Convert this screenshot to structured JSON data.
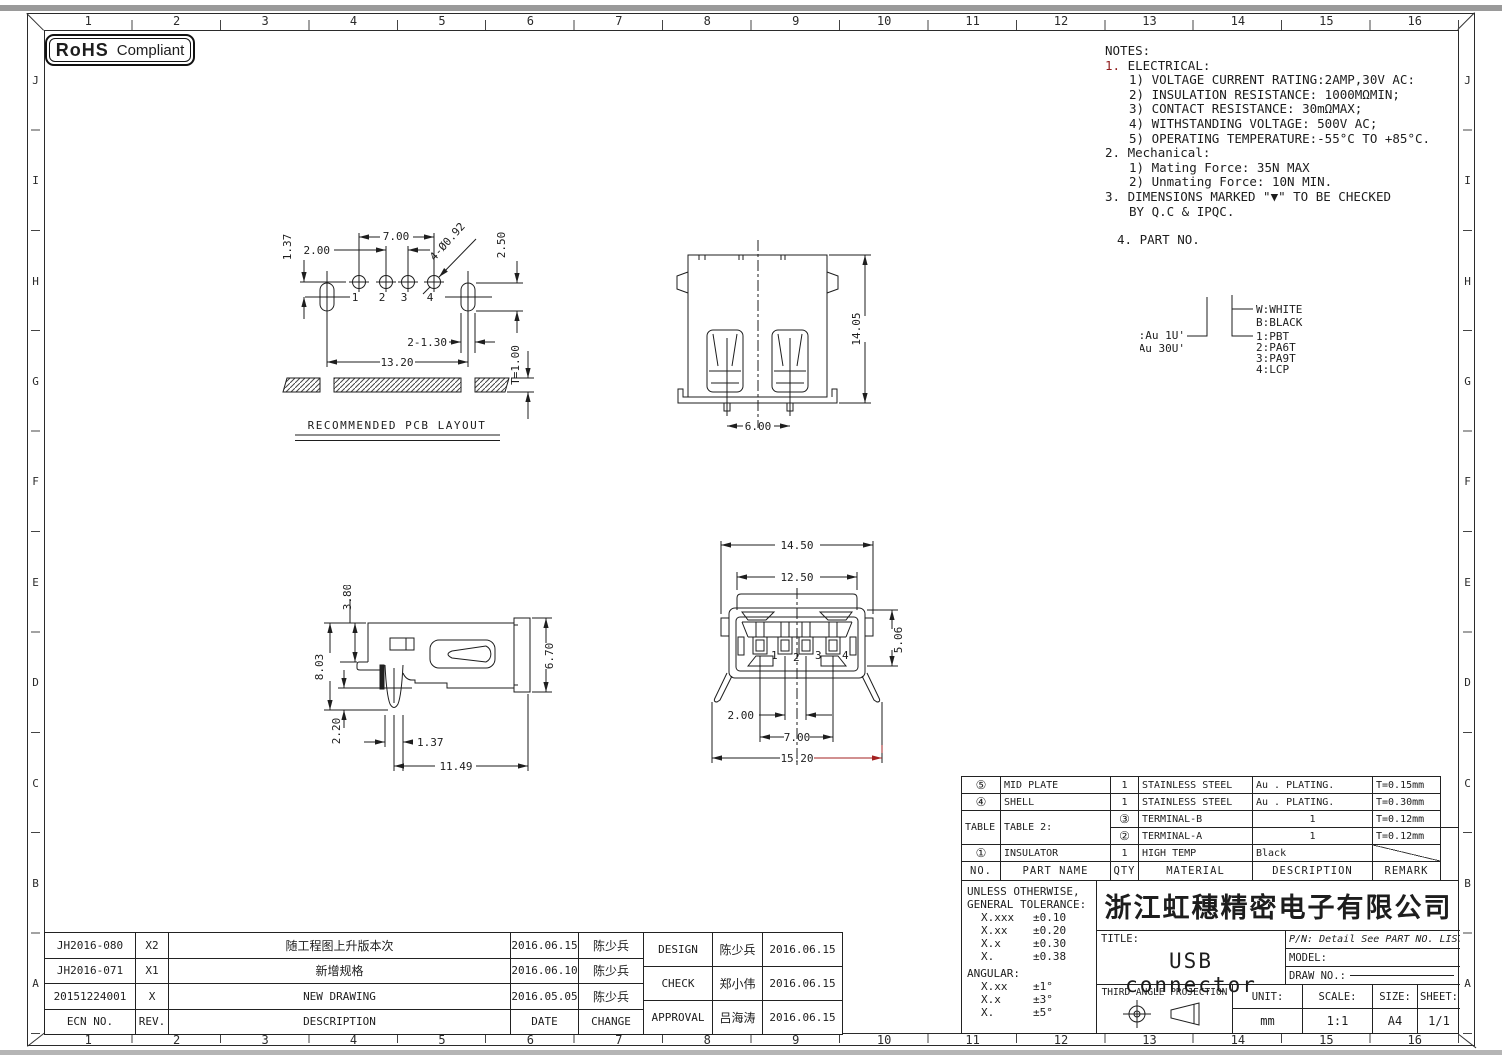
{
  "frame": {
    "cols": [
      "1",
      "2",
      "3",
      "4",
      "5",
      "6",
      "7",
      "8",
      "9",
      "10",
      "11",
      "12",
      "13",
      "14",
      "15",
      "16"
    ],
    "rows": [
      "J",
      "I",
      "H",
      "G",
      "F",
      "E",
      "D",
      "C",
      "B",
      "A"
    ]
  },
  "rohs": {
    "strong": "RoHS",
    "label": "Compliant"
  },
  "notes": {
    "title": "NOTES:",
    "n1num": "1.",
    "n1": "ELECTRICAL:",
    "e1": "1) VOLTAGE CURRENT RATING:2AMP,30V AC:",
    "e2": "2) INSULATION RESISTANCE: 1000MΩMIN;",
    "e3": "3) CONTACT RESISTANCE: 30mΩMAX;",
    "e4": "4) WITHSTANDING VOLTAGE: 500V AC;",
    "e5": "5) OPERATING TEMPERATURE:-55°C TO +85°C.",
    "n2num": "2.",
    "n2": "Mechanical:",
    "m1": "1) Mating Force: 35N  MAX",
    "m2": "2) Unmating Force: 10N  MIN.",
    "n3num": "3.",
    "n3": "DIMENSIONS MARKED \"▼\" TO BE CHECKED",
    "n3b": "BY Q.C & IPQC.",
    "n4num": "4.",
    "n4": "PART NO."
  },
  "legend": {
    "au1": "1:Au 1U'",
    "au2": "6:Au 30U'",
    "c1": "W:WHITE",
    "c2": "B:BLACK",
    "m1": "1:PBT",
    "m2": "2:PA6T",
    "m3": "3:PA9T",
    "m4": "4:LCP"
  },
  "pcb": {
    "title": "RECOMMENDED PCB LAYOUT",
    "d700": "7.00",
    "d200": "2.00",
    "d137": "1.37",
    "d250": "2.50",
    "dholes": "4-Ø0.92",
    "d130": "2-1.30",
    "d1320": "13.20",
    "dt": "T=1.00",
    "p1": "1",
    "p2": "2",
    "p3": "3",
    "p4": "4"
  },
  "rear": {
    "h": "14.05",
    "w": "6.00"
  },
  "side": {
    "d380": "3.80",
    "d803": "8.03",
    "d220": "2.20",
    "d137": "1.37",
    "d1149": "11.49",
    "d670": "6.70"
  },
  "front": {
    "d1450": "14.50",
    "d1250": "12.50",
    "d506": "5.06",
    "d200": "2.00",
    "d700": "7.00",
    "d1520": "15.20",
    "p1": "1",
    "p2": "2",
    "p3": "3",
    "p4": "4"
  },
  "parts": {
    "headers": {
      "no": "NO.",
      "name": "PART NAME",
      "qty": "QTY",
      "material": "MATERIAL",
      "desc": "DESCRIPTION",
      "remark": "REMARK"
    },
    "r5": {
      "no": "⑤",
      "name": "MID PLATE",
      "qty": "1",
      "material": "STAINLESS STEEL",
      "desc": "Au . PLATING.",
      "remark": "T=0.15mm"
    },
    "r4": {
      "no": "④",
      "name": "SHELL",
      "qty": "1",
      "material": "STAINLESS STEEL",
      "desc": "Au . PLATING.",
      "remark": "T=0.30mm"
    },
    "r3": {
      "no": "③",
      "name": "TERMINAL-B",
      "qty": "1",
      "remark": "T=0.12mm"
    },
    "r2": {
      "no": "②",
      "name": "TERMINAL-A",
      "qty": "1",
      "remark": "T=0.12mm"
    },
    "r1": {
      "no": "①",
      "name": "INSULATOR",
      "qty": "1",
      "material": "HIGH TEMP",
      "desc": "Black"
    },
    "table2a": "TABLE 2:",
    "table2b": "TABLE 2:"
  },
  "tolerance": {
    "l1": "UNLESS OTHERWISE,",
    "l2": "GENERAL TOLERANCE:",
    "rows": [
      {
        "k": "X.xxx",
        "v": "±0.10"
      },
      {
        "k": "X.xx",
        "v": "±0.20"
      },
      {
        "k": "X.x",
        "v": "±0.30"
      },
      {
        "k": "X.",
        "v": "±0.38"
      }
    ],
    "angular": "ANGULAR:",
    "arows": [
      {
        "k": "X.xx",
        "v": "±1°"
      },
      {
        "k": "X.x",
        "v": "±3°"
      },
      {
        "k": "X.",
        "v": "±5°"
      }
    ]
  },
  "titleblock": {
    "company": "浙江虹穗精密电子有限公司",
    "title_label": "TITLE:",
    "title": "USB connector",
    "pn": "P/N: Detail See PART NO. LIST",
    "model": "MODEL:",
    "drawno": "DRAW NO.:",
    "projection": "THIRD ANGLE PROJECTION",
    "unit_label": "UNIT:",
    "unit": "mm",
    "scale_label": "SCALE:",
    "scale": "1:1",
    "size_label": "SIZE:",
    "size": "A4",
    "sheet_label": "SHEET:",
    "sheet": "1/1"
  },
  "revisions": {
    "headers": {
      "ecn": "ECN NO.",
      "rev": "REV.",
      "desc": "DESCRIPTION",
      "date": "DATE",
      "change": "CHANGE"
    },
    "rows": [
      {
        "ecn": "JH2016-080",
        "rev": "X2",
        "desc": "随工程图上升版本次",
        "date": "2016.06.15",
        "change": "陈少兵"
      },
      {
        "ecn": "JH2016-071",
        "rev": "X1",
        "desc": "新增规格",
        "date": "2016.06.10",
        "change": "陈少兵"
      },
      {
        "ecn": "20151224001",
        "rev": "X",
        "desc": "NEW DRAWING",
        "date": "2016.05.05",
        "change": "陈少兵"
      }
    ],
    "approvals": [
      {
        "role": "DESIGN",
        "name": "陈少兵",
        "date": "2016.06.15"
      },
      {
        "role": "CHECK",
        "name": "郑小伟",
        "date": "2016.06.15"
      },
      {
        "role": "APPROVAL",
        "name": "吕海涛",
        "date": "2016.06.15"
      }
    ]
  },
  "colors": {
    "line": "#1e1e1e",
    "red": "#a32020",
    "note_red": "#8f1c1c"
  }
}
